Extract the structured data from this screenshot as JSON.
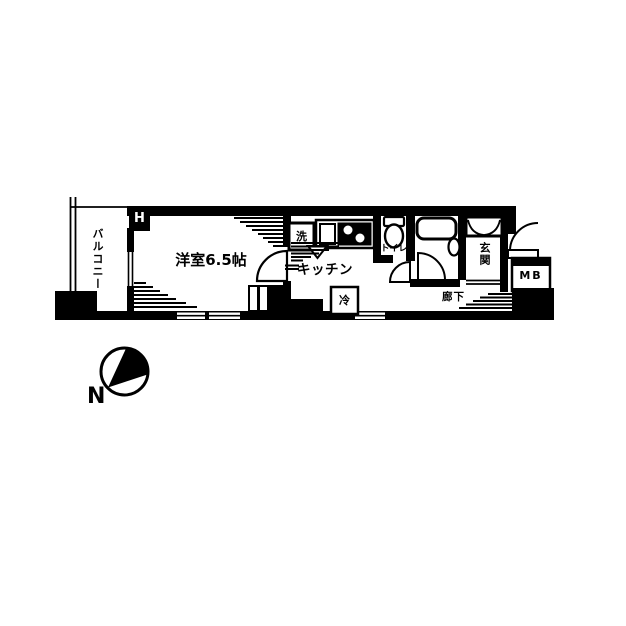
{
  "colors": {
    "ink": "#000000",
    "paper": "#ffffff"
  },
  "plan": {
    "type": "floor-plan",
    "labels": {
      "balcony": "バルコニー",
      "hanger_mark": "H",
      "room": "洋室6.5帖",
      "washer": "洗",
      "kitchen": "キッチン",
      "fridge": "冷",
      "toilet": "トイレ",
      "entrance": "玄関",
      "meter_box": "MB",
      "corridor": "廊下",
      "compass_north": "N"
    }
  }
}
